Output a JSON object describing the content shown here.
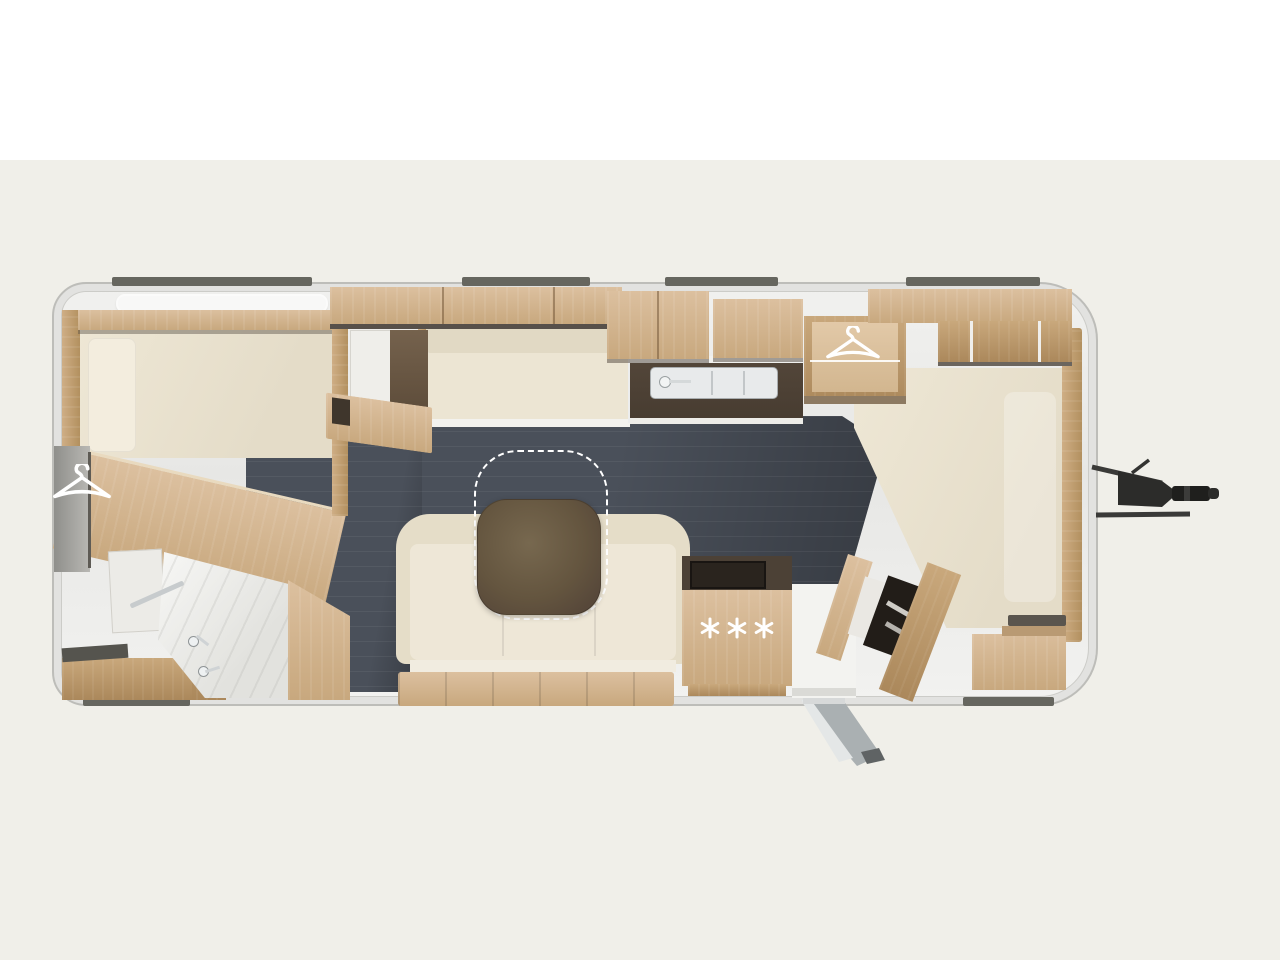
{
  "page": {
    "title": "Caravan floor plan — top view",
    "background_top": "#ffffff",
    "background_bottom": "#f0efe9"
  },
  "palette": {
    "bg-top": "#ffffff",
    "bg-bottom": "#f0efe9",
    "shell": "#ececea",
    "shell-border": "#bdbdb9",
    "bumper": "#66665f",
    "wood1": "#dcc09f",
    "wood2": "#c8a87e",
    "wood3": "#ab885b",
    "cream": "#eae3d1",
    "cream-light": "#f1ebdc",
    "floor-dark": "#4a505a",
    "counter-dark": "#4c4136",
    "table-brown": "#64553f",
    "metal": "#2d2d2b",
    "white-fixture": "#f4f4f2"
  },
  "floorplan": {
    "type": "caravan-top-view-floorplan",
    "orientation": "tow-hitch-on-right",
    "rooms": [
      {
        "name": "rear-bedroom",
        "features": [
          "double-bed",
          "headboard",
          "overhead-cabinets",
          "skylight",
          "wardrobe-with-hanger",
          "chest",
          "desk",
          "storage-niches"
        ]
      },
      {
        "name": "bathroom",
        "features": [
          "shower-tray",
          "washbasin-faucets",
          "bench",
          "towel-rail",
          "cabinet"
        ]
      },
      {
        "name": "lounge",
        "features": [
          "sofa",
          "movable-table-with-dashed-position-outline",
          "side-bench"
        ]
      },
      {
        "name": "kitchen",
        "features": [
          "sink-with-faucet",
          "dark-worktop",
          "overhead-cabinets",
          "fridge-freezer-with-snowflakes",
          "hob"
        ]
      },
      {
        "name": "entry",
        "features": [
          "door-opening",
          "exterior-step-ramp"
        ]
      },
      {
        "name": "front-bedroom",
        "features": [
          "large-bed",
          "wardrobe-with-hanger",
          "overhead-cabinets",
          "bed-steps-cabinet",
          "side-cabinets"
        ]
      }
    ],
    "icons": [
      {
        "name": "hanger-icon",
        "count": 2,
        "color": "#ffffff"
      },
      {
        "name": "snowflake-icon",
        "count": 3,
        "color": "#ffffff"
      },
      {
        "name": "faucet-icon",
        "count": 3,
        "color": "#dfe3e5"
      }
    ],
    "fridge_symbol": "✳✳✳",
    "exterior": {
      "tow_hitch": "a-frame-drawbar-with-coupling",
      "rub_rails_top": 4,
      "rub_rails_bottom": 3,
      "entry_step": "fold-out-ramp"
    }
  }
}
